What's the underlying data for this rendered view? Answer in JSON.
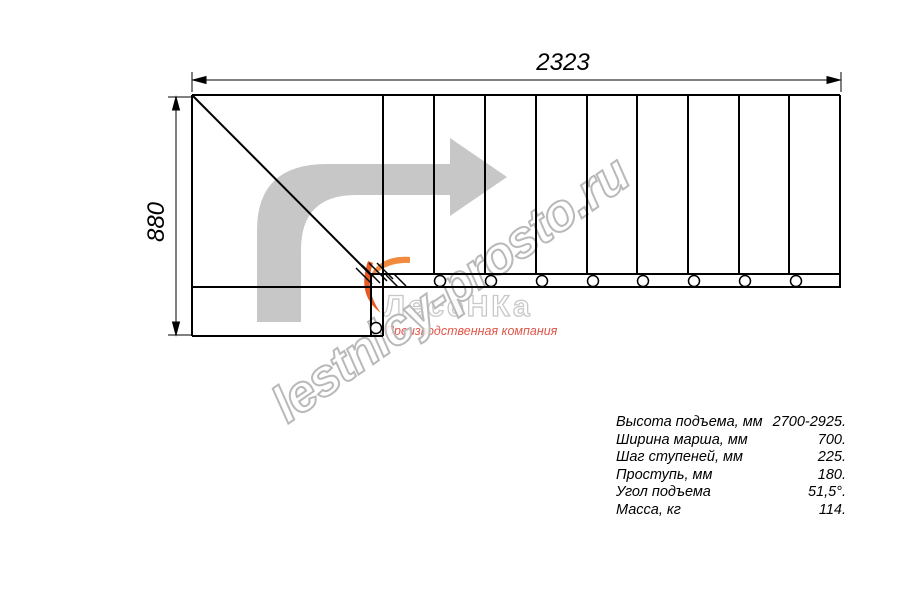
{
  "dimensions": {
    "width_mm": "2323",
    "height_mm": "880"
  },
  "watermark": {
    "text": "lestnicy-prosto.ru"
  },
  "logo": {
    "brand": "ЛесеНКа",
    "subtitle": "Производственная компания"
  },
  "specs": {
    "rows": [
      {
        "label": "Высота подъема, мм",
        "value": "2700-2925."
      },
      {
        "label": "Ширина марша, мм",
        "value": "700."
      },
      {
        "label": "Шаг ступеней, мм",
        "value": "225."
      },
      {
        "label": "Проступь, мм",
        "value": "180."
      },
      {
        "label": "Угол подъема",
        "value": "51,5°."
      },
      {
        "label": "Масса, кг",
        "value": "114."
      }
    ]
  },
  "colors": {
    "line": "#000000",
    "arrow_gray": "#c7c7c7",
    "watermark_stroke": "#b9b9b9",
    "logo_gray": "#c8c8c8",
    "subtitle_red": "#e25549",
    "icon_orange": "#f18a3d",
    "icon_deep_orange": "#e85a22"
  }
}
